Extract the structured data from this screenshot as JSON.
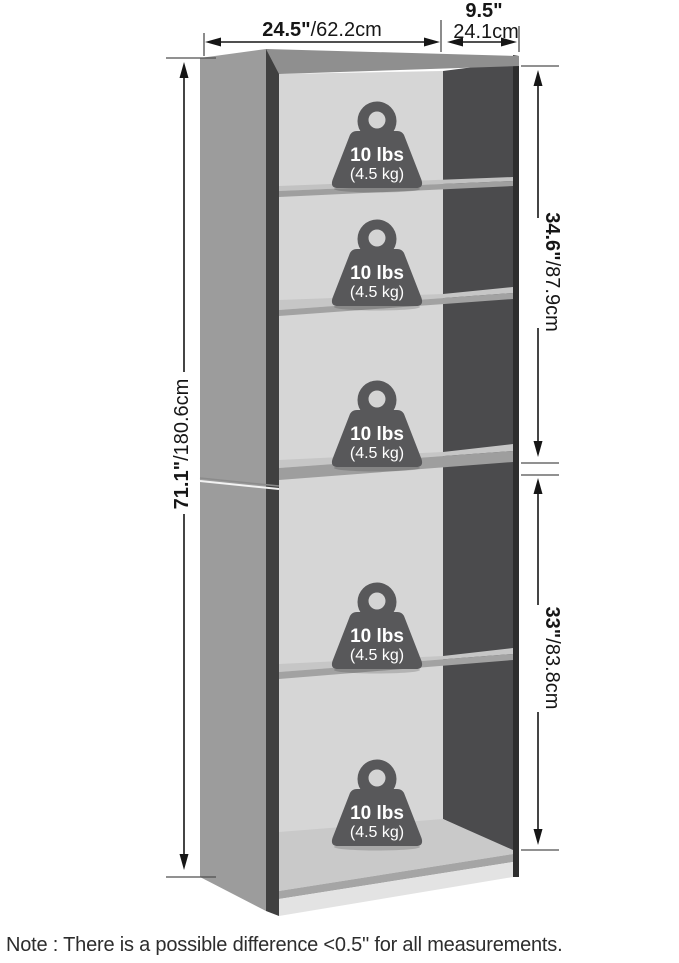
{
  "diagram": {
    "title_type": "bookcase-dimension-diagram",
    "dimensions": {
      "width": {
        "imperial": "24.5\"",
        "metric": "/62.2cm"
      },
      "depth": {
        "imperial": "9.5\"",
        "metric": "24.1cm"
      },
      "height": {
        "imperial": "71.1\"",
        "metric": "/180.6cm"
      },
      "upper_section": {
        "imperial": "34.6\"",
        "metric": "/87.9cm"
      },
      "lower_section": {
        "imperial": "33\"",
        "metric": "/83.8cm"
      }
    },
    "weights": [
      {
        "lbs": "10 lbs",
        "kg": "(4.5 kg)"
      },
      {
        "lbs": "10 lbs",
        "kg": "(4.5 kg)"
      },
      {
        "lbs": "10 lbs",
        "kg": "(4.5 kg)"
      },
      {
        "lbs": "10 lbs",
        "kg": "(4.5 kg)"
      },
      {
        "lbs": "10 lbs",
        "kg": "(4.5 kg)"
      }
    ],
    "note": "Note : There is a possible difference <0.5\" for all measurements.",
    "colors": {
      "side_panel": "#9c9c9c",
      "edge_dark": "#404040",
      "top_panel": "#8f8f8f",
      "interior_back": "#d6d6d6",
      "interior_right": "#4b4b4d",
      "shelf_top": "#c6c6c6",
      "shelf_edge": "#a2a2a2",
      "kick_plate": "#e3e3e3",
      "weight_icon": "#58585a",
      "dimension_line": "#161616"
    }
  }
}
